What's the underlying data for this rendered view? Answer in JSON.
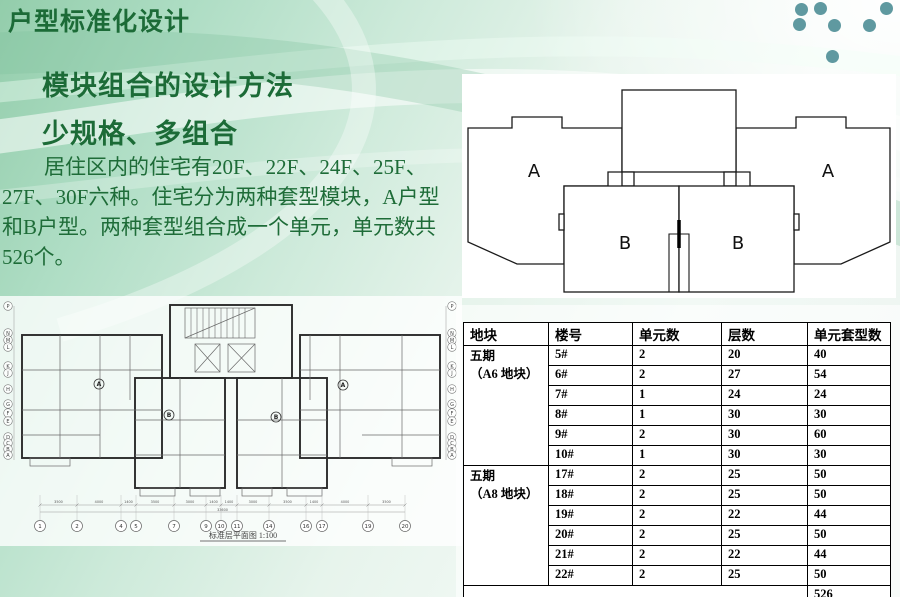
{
  "slide": {
    "title": "户型标准化设计",
    "subtitle1": "模块组合的设计方法",
    "subtitle2": "少规格、多组合",
    "paragraph": "居住区内的住宅有20F、22F、24F、25F、27F、30F六种。住宅分为两种套型模块，A户型和B户型。两种套型组合成一个单元，单元数共526个。"
  },
  "diagram": {
    "labels": {
      "a_left": "A",
      "a_right": "A",
      "b_left": "B",
      "b_right": "B"
    }
  },
  "floorplan": {
    "caption": "标准层平面图 1:100",
    "grid_numbers": [
      "1",
      "2",
      "4",
      "5",
      "7",
      "9",
      "10",
      "11",
      "14",
      "16",
      "17",
      "19",
      "20"
    ],
    "grid_letters": [
      "P",
      "N",
      "M",
      "L",
      "K",
      "J",
      "H",
      "G",
      "F",
      "E",
      "D",
      "C",
      "B",
      "A"
    ],
    "dimensions": [
      "3500",
      "4000",
      "1400",
      "3500",
      "3000",
      "1400",
      "1400",
      "3000",
      "3500",
      "1400",
      "4000",
      "3500"
    ],
    "total_dimension": "33600",
    "unit_markers": [
      "A",
      "B",
      "B",
      "A"
    ]
  },
  "table": {
    "headers": [
      "地块",
      "楼号",
      "单元数",
      "层数",
      "单元套型数"
    ],
    "groups": [
      {
        "block": "五期",
        "block2": "（A6 地块）",
        "rows": [
          [
            "5#",
            "2",
            "20",
            "40"
          ],
          [
            "6#",
            "2",
            "27",
            "54"
          ],
          [
            "7#",
            "1",
            "24",
            "24"
          ],
          [
            "8#",
            "1",
            "30",
            "30"
          ],
          [
            "9#",
            "2",
            "30",
            "60"
          ],
          [
            "10#",
            "1",
            "30",
            "30"
          ]
        ]
      },
      {
        "block": "五期",
        "block2": "（A8 地块）",
        "rows": [
          [
            "17#",
            "2",
            "25",
            "50"
          ],
          [
            "18#",
            "2",
            "25",
            "50"
          ],
          [
            "19#",
            "2",
            "22",
            "44"
          ],
          [
            "20#",
            "2",
            "25",
            "50"
          ],
          [
            "21#",
            "2",
            "22",
            "44"
          ],
          [
            "22#",
            "2",
            "25",
            "50"
          ]
        ]
      }
    ],
    "total": "526"
  },
  "colors": {
    "heading_green": "#1c6b37",
    "body_green": "#1e6c38",
    "dot_teal": "#5f99a0",
    "background_green": "#93cdab",
    "line_black": "#1a1a1a",
    "table_border": "#000000"
  }
}
